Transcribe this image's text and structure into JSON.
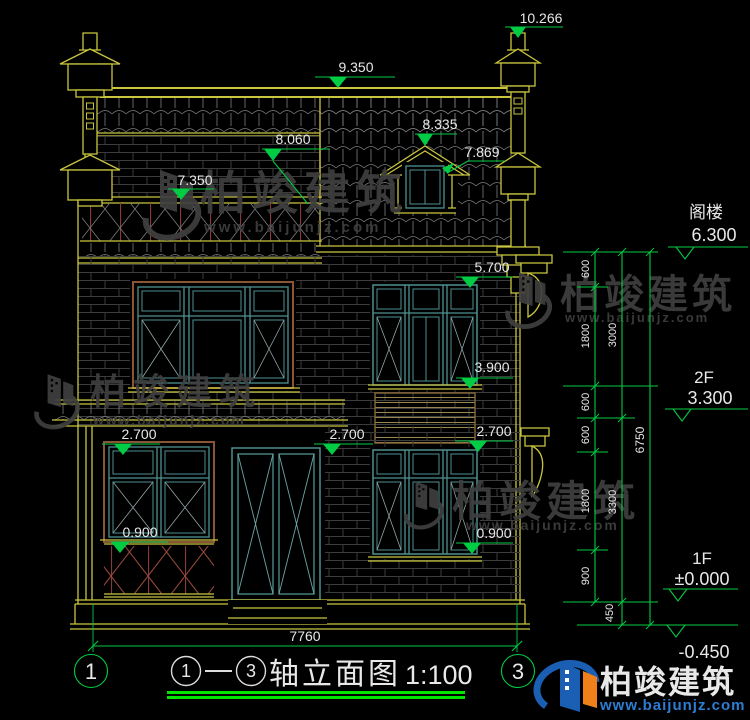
{
  "colors": {
    "background": "#000000",
    "line_yellow": "#c9c53f",
    "dim_green": "#00cc44",
    "frame_teal": "#4e9090",
    "railing_red": "#8a3a3a",
    "text_white": "#e8e8e8",
    "watermark_gray": "#3f3f3f",
    "logo_blue": "#1b5fb5",
    "logo_orange": "#f08019",
    "logo_url_blue": "#2d7dd2"
  },
  "brand": {
    "name": "柏竣建筑",
    "url": "www.baijunjz.com"
  },
  "markers": {
    "v10266": "10.266",
    "v9350": "9.350",
    "v8335": "8.335",
    "v8060": "8.060",
    "v7869": "7.869",
    "v7350": "7.350",
    "v5700": "5.700",
    "v3900": "3.900",
    "v2700_left": "2.700",
    "v2700_center": "2.700",
    "v2700_right": "2.700",
    "v0900_left": "0.900",
    "v0900_right": "0.900"
  },
  "levels": {
    "attic_label": "阁楼",
    "attic_value": "6.300",
    "f2_label": "2F",
    "f2_value": "3.300",
    "f1_label": "1F",
    "f1_value": "±0.000",
    "base_value": "-0.450"
  },
  "dims": {
    "total_width": "7760",
    "total_height": "6750",
    "chain_a": [
      "600",
      "1800",
      "600",
      "600",
      "1800",
      "900"
    ],
    "chain_b": [
      "3000",
      "3300",
      "450"
    ]
  },
  "axes": {
    "left": "1",
    "right": "3"
  },
  "title": {
    "axis_from": "1",
    "axis_to": "3",
    "name": "轴立面图",
    "scale": "1:100"
  }
}
